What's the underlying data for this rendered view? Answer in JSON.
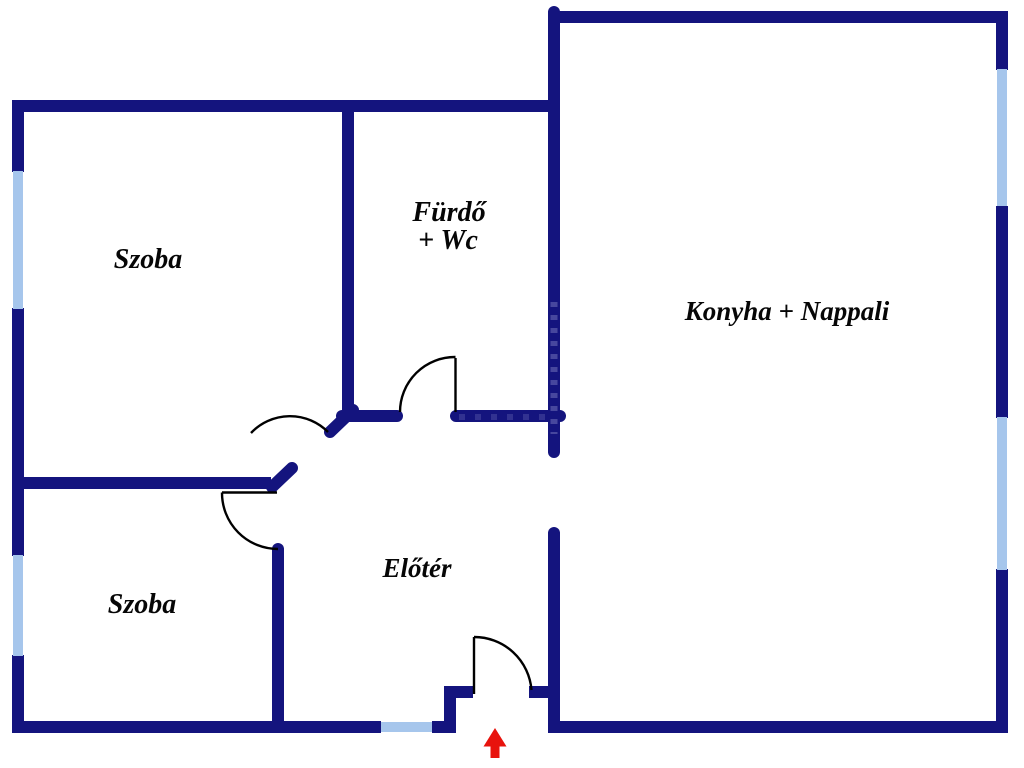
{
  "page": {
    "background": "#FFFFFF",
    "kind": "apartment floor plan"
  },
  "colors": {
    "wall": "#14147E",
    "window": "#A6C6EC",
    "door_line": "#000000",
    "arrow": "#E8130D",
    "text": "#060606",
    "watermark": "#8585C6"
  },
  "rooms": {
    "szoba_top": {
      "label": "Szoba"
    },
    "furdo": {
      "line1": "Fürdő",
      "line2": "+ Wc"
    },
    "konyha_nappali": {
      "label": "Konyha + Nappali"
    },
    "szoba_bottom": {
      "label": "Szoba"
    },
    "eloter": {
      "label": "Előtér"
    }
  },
  "entrance": {
    "marker": "up-arrow"
  }
}
